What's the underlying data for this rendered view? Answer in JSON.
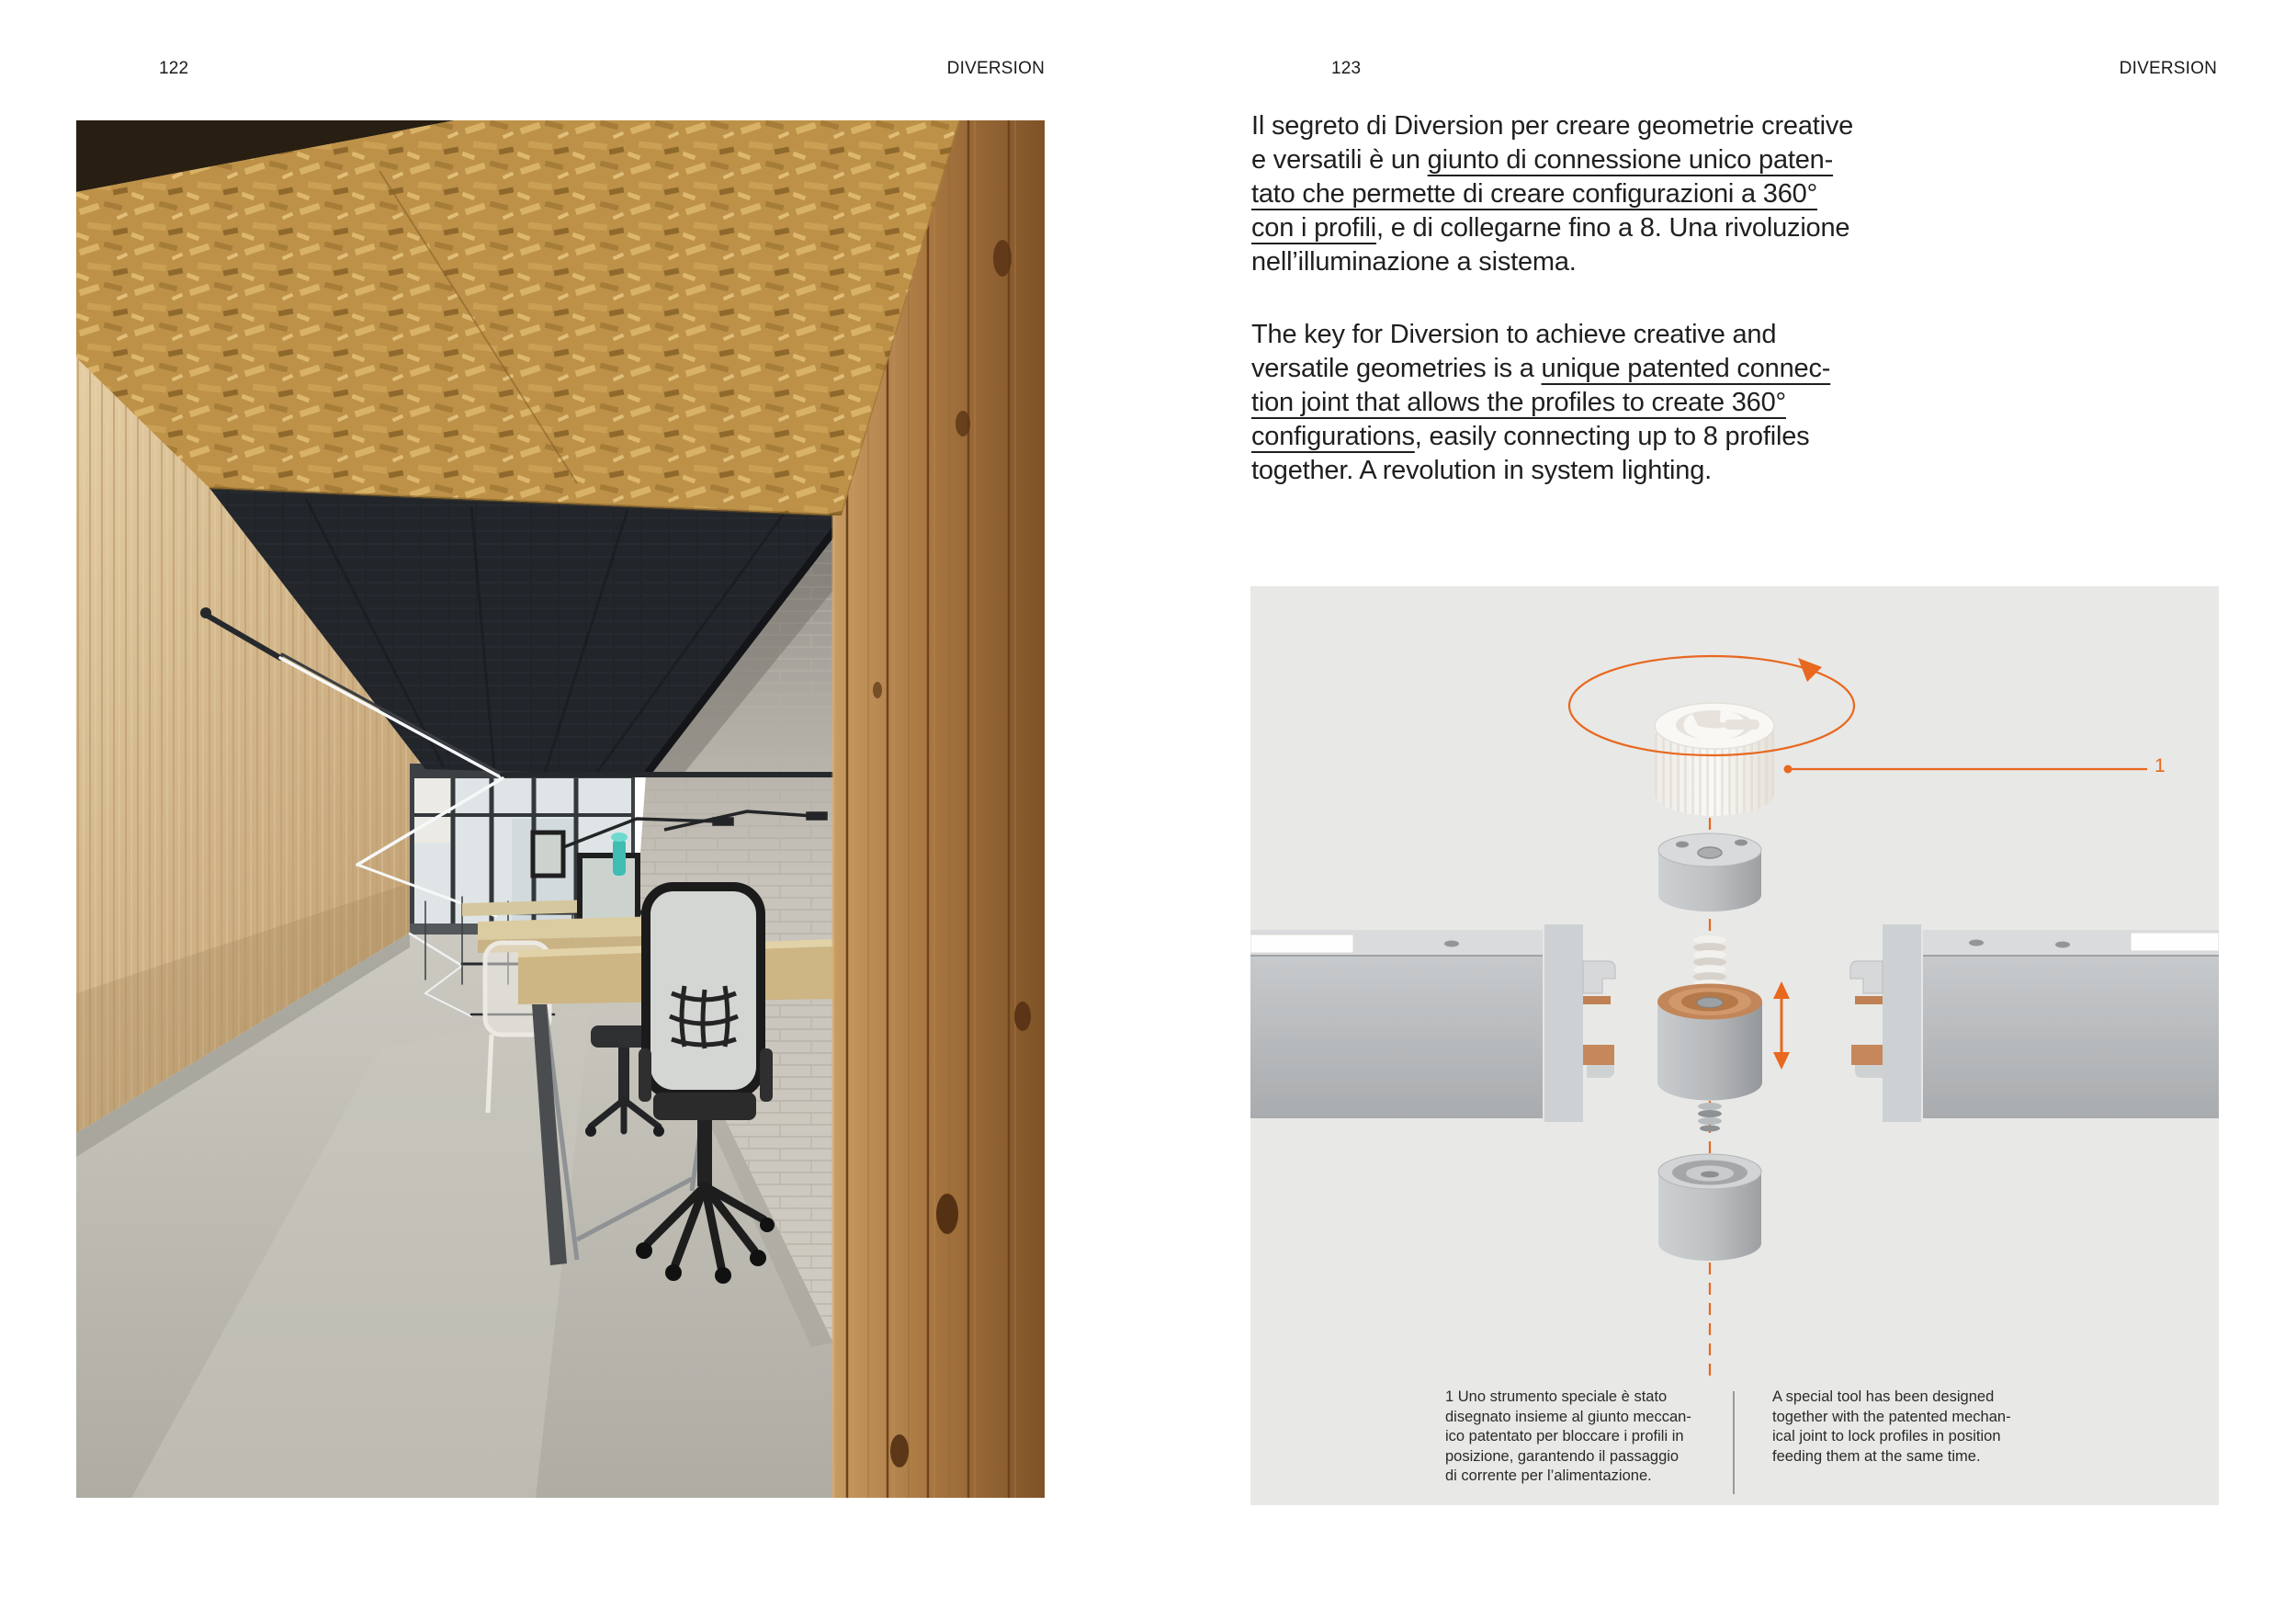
{
  "colors": {
    "accent": "#e8681f",
    "panel_background": "#e8e8e6",
    "text": "#1d1d1d"
  },
  "left_page": {
    "page_number": "122",
    "header": "DIVERSION"
  },
  "right_page": {
    "page_number": "123",
    "header": "DIVERSION",
    "intro_it": {
      "lines": [
        [
          {
            "t": "Il segreto di Diversion per creare geometrie creative",
            "u": false
          }
        ],
        [
          {
            "t": "e versatili è un ",
            "u": false
          },
          {
            "t": "giunto di connessione unico paten-",
            "u": true
          }
        ],
        [
          {
            "t": "tato che permette di creare configurazioni a 360°",
            "u": true
          }
        ],
        [
          {
            "t": "con i profili",
            "u": true
          },
          {
            "t": ", e di collegarne fino a 8. Una rivoluzione",
            "u": false
          }
        ],
        [
          {
            "t": "nell’illuminazione a sistema.",
            "u": false
          }
        ]
      ]
    },
    "intro_en": {
      "lines": [
        [
          {
            "t": "The key for Diversion to achieve creative and",
            "u": false
          }
        ],
        [
          {
            "t": "versatile geometries is a ",
            "u": false
          },
          {
            "t": "unique patented connec-",
            "u": true
          }
        ],
        [
          {
            "t": "tion joint that allows the profiles to create 360°",
            "u": true
          }
        ],
        [
          {
            "t": "configurations",
            "u": true
          },
          {
            "t": ", easily connecting up to 8 profiles",
            "u": false
          }
        ],
        [
          {
            "t": "together. A revolution in system lighting.",
            "u": false
          }
        ]
      ]
    },
    "diagram": {
      "callout": "1",
      "footnote_it": "1 Uno strumento speciale è stato\ndisegnato insieme al giunto meccan-\nico patentato per bloccare i profili in\nposizione, garantendo il passaggio\ndi corrente per l’alimentazione.",
      "footnote_en": "A special tool has been designed\ntogether with the patented mechan-\nical joint to lock profiles in position\nfeeding them at the same time."
    }
  }
}
